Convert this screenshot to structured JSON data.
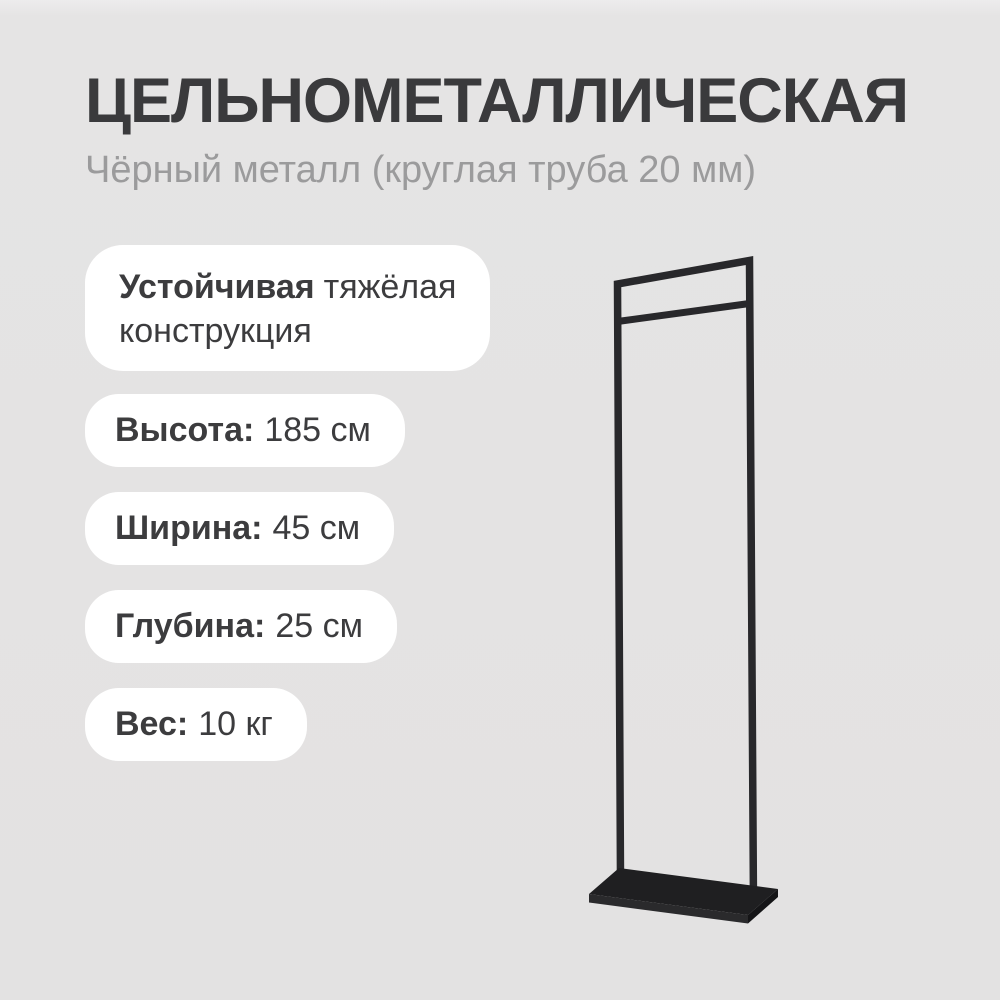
{
  "header": {
    "title": "ЦЕЛЬНОМЕТАЛЛИЧЕСКАЯ",
    "subtitle": "Чёрный металл (круглая труба 20 мм)"
  },
  "feature_card": {
    "bold_text": "Устойчивая",
    "line1_rest": "тяжёлая",
    "line2": "конструкция"
  },
  "specs": [
    {
      "label": "Высота:",
      "value": "185 см"
    },
    {
      "label": "Ширина:",
      "value": "45 см"
    },
    {
      "label": "Глубина:",
      "value": "25 см"
    },
    {
      "label": "Вес:",
      "value": "10 кг"
    }
  ],
  "product_image": {
    "description": "black metal clothes rack line-art with flat base plate",
    "frame_color": "#28282b",
    "hanger_bar_color": "#28282b",
    "base_top_color": "#1f1f21",
    "base_front_color": "#2a2a2c",
    "base_side_color": "#151517"
  },
  "colors": {
    "background": "#e3e2e2",
    "title_text": "#3a3a3c",
    "subtitle_text": "#9b9b9c",
    "card_background": "#ffffff",
    "card_text": "#3c3c3e"
  }
}
